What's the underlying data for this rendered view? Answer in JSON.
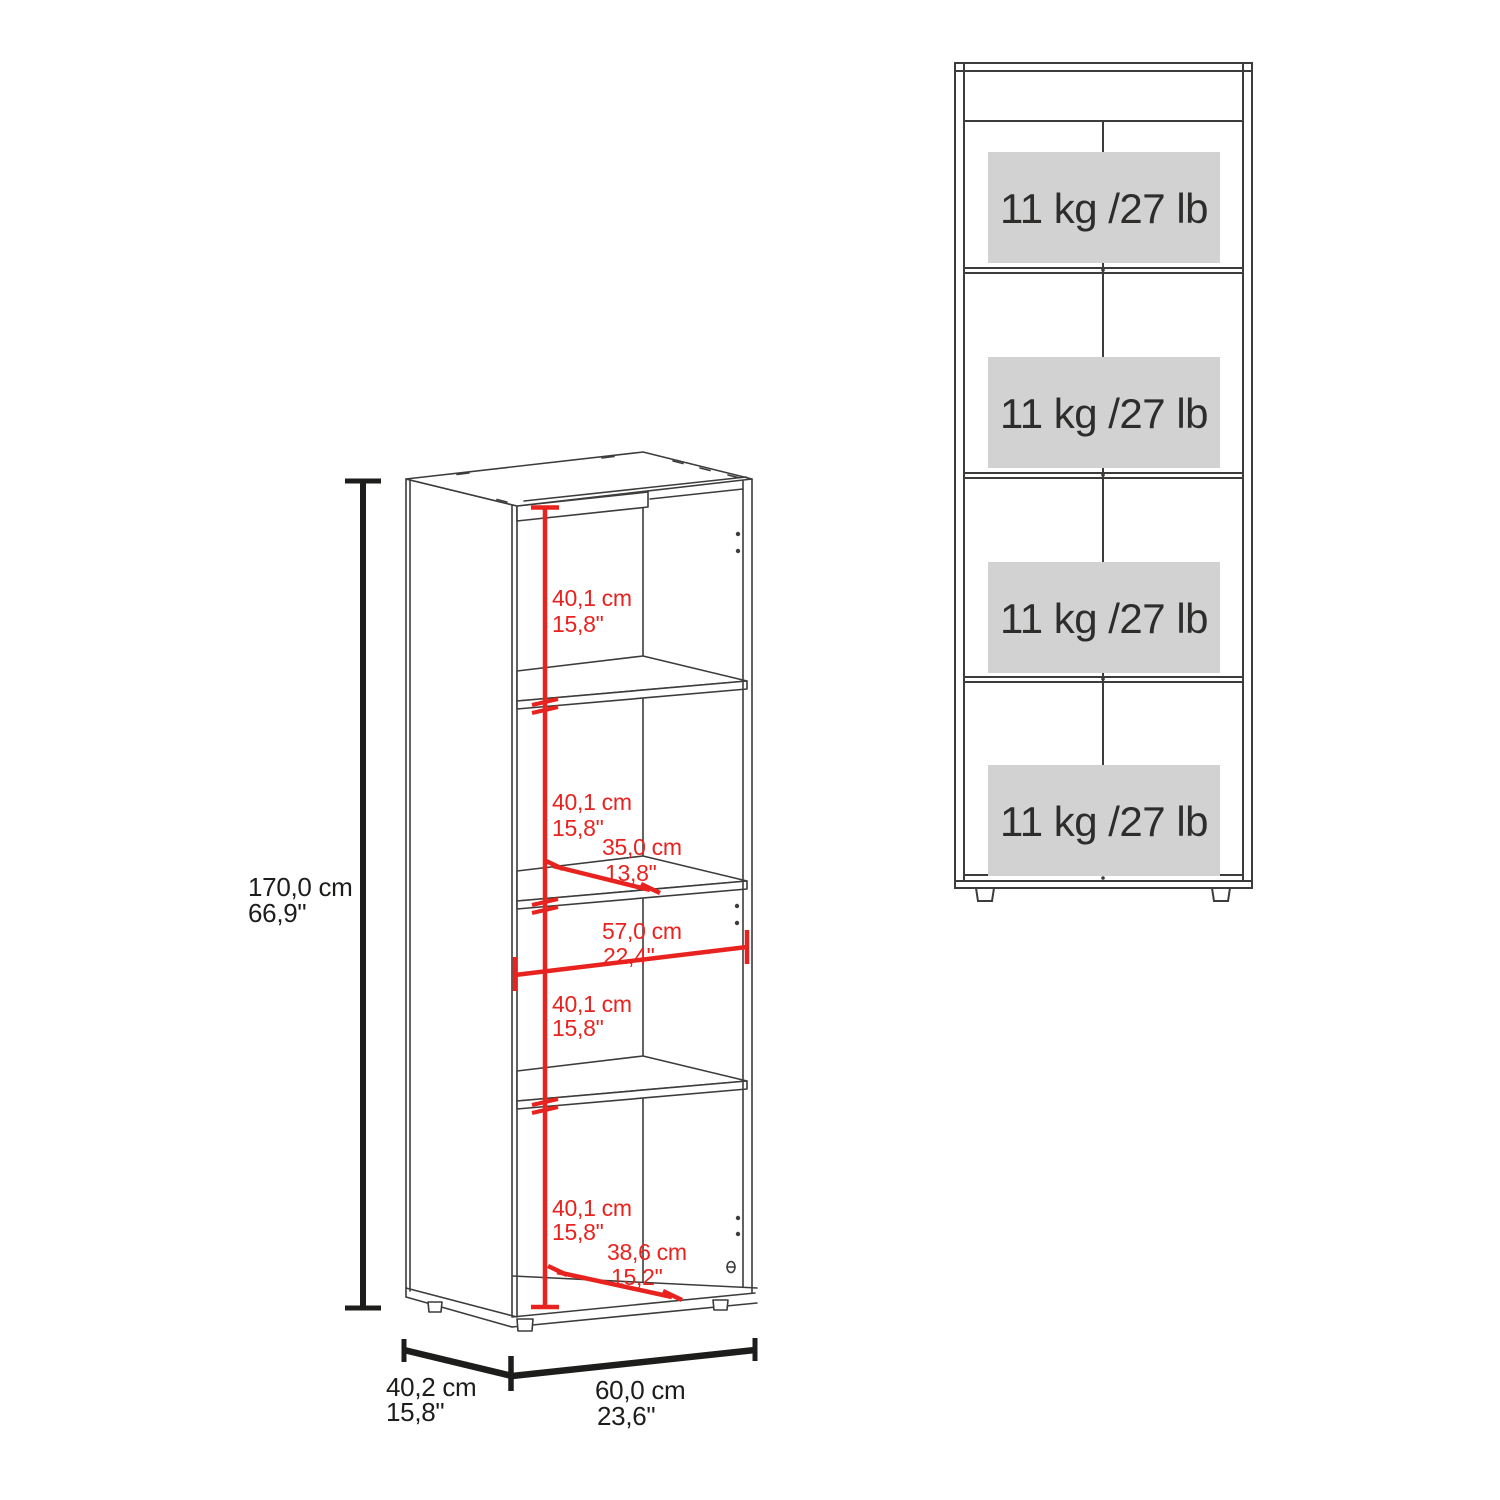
{
  "colors": {
    "wireframe_line": "#3d3c3b",
    "dimension_red": "#e8231f",
    "dimension_black": "#1d1d1b",
    "capacity_box_gray": "#d2d2d2",
    "capacity_text": "#2e2d2c"
  },
  "isometric_view": {
    "overall_height": {
      "cm": "170,0 cm",
      "inches": "66,9\""
    },
    "overall_depth": {
      "cm": "40,2 cm",
      "inches": "15,8\""
    },
    "overall_width": {
      "cm": "60,0 cm",
      "inches": "23,6\""
    },
    "shelf_spacings": [
      {
        "cm": "40,1 cm",
        "inches": "15,8\""
      },
      {
        "cm": "40,1 cm",
        "inches": "15,8\""
      },
      {
        "cm": "40,1 cm",
        "inches": "15,8\""
      },
      {
        "cm": "40,1 cm",
        "inches": "15,8\""
      }
    ],
    "shelf_depth": {
      "cm": "35,0 cm",
      "inches": "13,8\""
    },
    "interior_width": {
      "cm": "57,0 cm",
      "inches": "22,4\""
    },
    "bottom_depth": {
      "cm": "38,6 cm",
      "inches": "15,2\""
    }
  },
  "front_view": {
    "shelf_capacities": [
      {
        "label": "11 kg /27 lb"
      },
      {
        "label": "11 kg /27 lb"
      },
      {
        "label": "11 kg /27 lb"
      },
      {
        "label": "11 kg /27 lb"
      }
    ]
  }
}
